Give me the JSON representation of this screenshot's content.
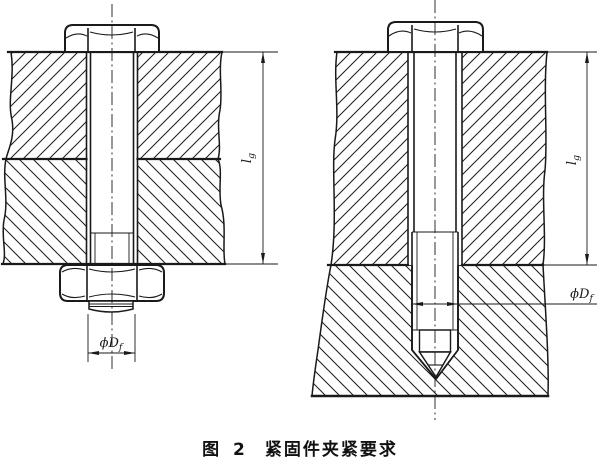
{
  "figure": {
    "caption": {
      "prefix": "图 2",
      "title": "紧固件夹紧要求"
    },
    "labels": {
      "grip_length": {
        "main": "l",
        "sub": "g"
      },
      "thread_diameter": {
        "phi": "ϕ",
        "main": "D",
        "sub": "f"
      }
    },
    "colors": {
      "line": "#1a1a1a",
      "background": "#ffffff"
    }
  }
}
